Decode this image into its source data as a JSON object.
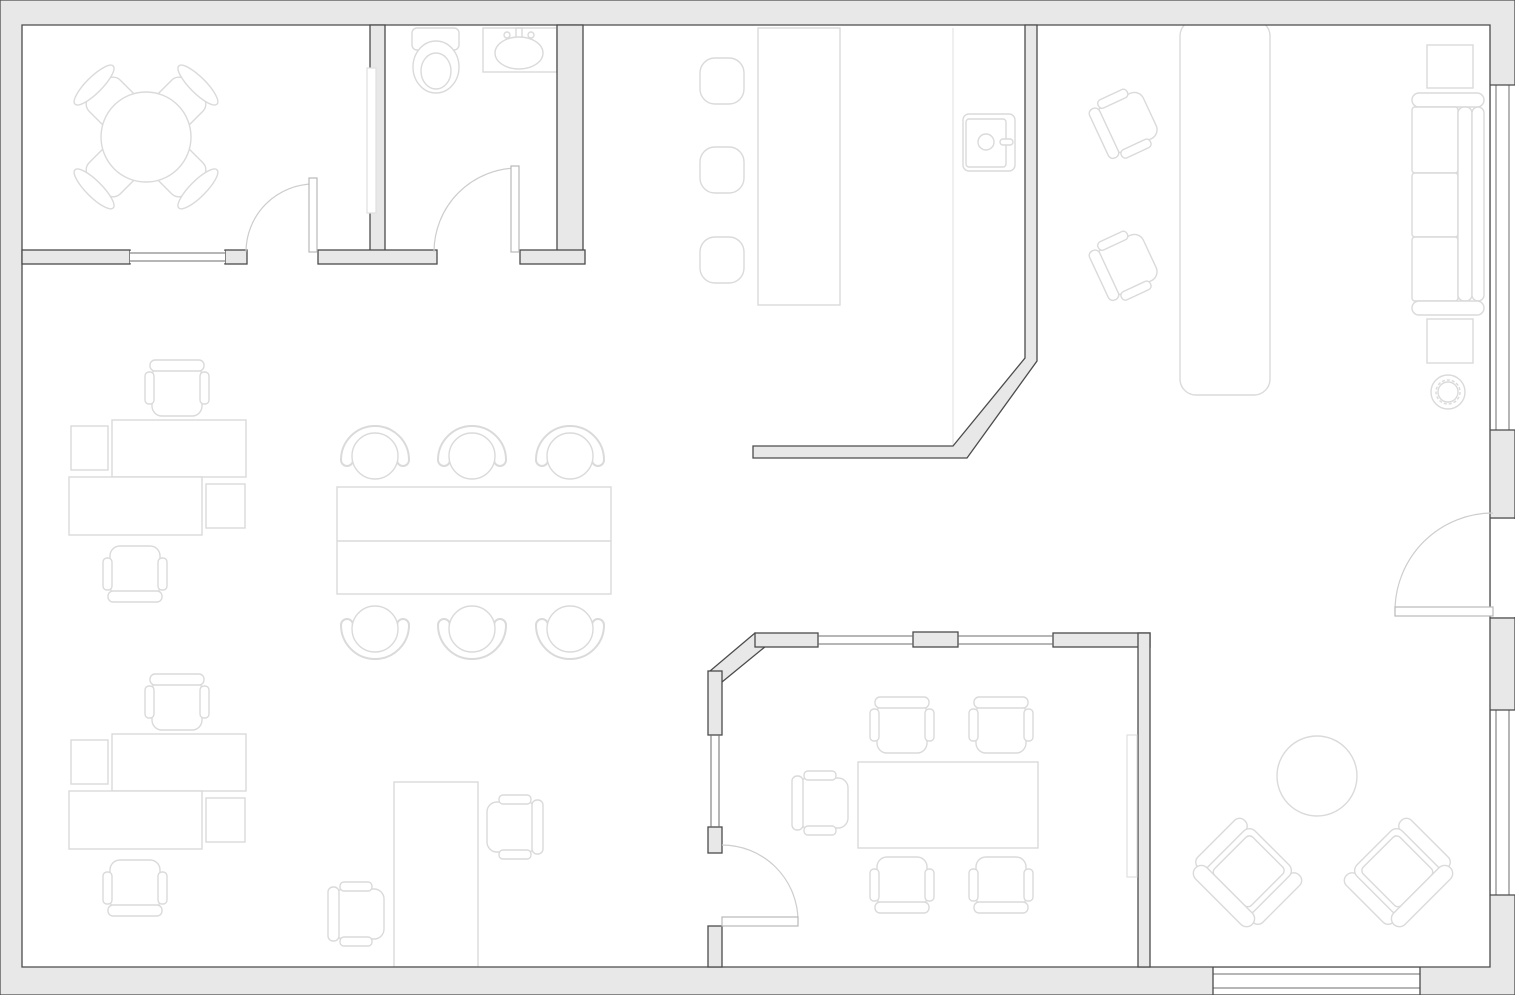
{
  "meta": {
    "title": "Office floor plan",
    "diagram_type": "architectural-floor-plan",
    "canvas": {
      "width": 1515,
      "height": 995
    },
    "visible_text": []
  },
  "colors": {
    "background": "#ffffff",
    "wall_fill": "#e8e8e8",
    "wall_stroke": "#4b4b4b",
    "furniture_stroke": "#dadada",
    "furniture_fill": "#ffffff",
    "glass_stroke": "#6e6e6e",
    "door_stroke": "#cdcdcd"
  },
  "inventory": {
    "rooms": [
      {
        "name": "small-meeting-room",
        "location": "top-left",
        "furniture": [
          "round-table",
          "chair x4",
          "wall-board"
        ],
        "openings": [
          "door-to-hall",
          "interior-window"
        ]
      },
      {
        "name": "bathroom",
        "location": "top-center-left",
        "furniture": [
          "toilet",
          "sink-vanity"
        ],
        "openings": [
          "door"
        ]
      },
      {
        "name": "kitchen-bar",
        "location": "top-center",
        "furniture": [
          "bar-counter",
          "bar-stool x3",
          "side-counter",
          "appliance"
        ],
        "openings": [
          "open-corner-with-diagonal-wall"
        ]
      },
      {
        "name": "open-office",
        "location": "center-left",
        "furniture": [
          "desk-cluster x2 (2 desks, 2 returns, 2 chairs each)",
          "conference-table",
          "conference-chair x6",
          "standing-desk",
          "task-chair x2"
        ],
        "openings": []
      },
      {
        "name": "reception-lounge",
        "location": "right",
        "furniture": [
          "long-table",
          "task-chair x2",
          "sofa",
          "side-table x2",
          "plant"
        ],
        "openings": [
          "entry-door-right-wall",
          "window x2"
        ]
      },
      {
        "name": "large-meeting-room",
        "location": "bottom-center",
        "furniture": [
          "meeting-table",
          "chair x5",
          "wall-board"
        ],
        "openings": [
          "door",
          "glazed-partition x4"
        ]
      },
      {
        "name": "corner-lounge",
        "location": "bottom-right",
        "furniture": [
          "armchair x2",
          "round-coffee-table"
        ],
        "openings": [
          "window-bottom",
          "window-right"
        ]
      }
    ],
    "counts": {
      "doors": 4,
      "exterior_windows": 3,
      "interior_windows": 5,
      "chairs_total": 24
    }
  }
}
